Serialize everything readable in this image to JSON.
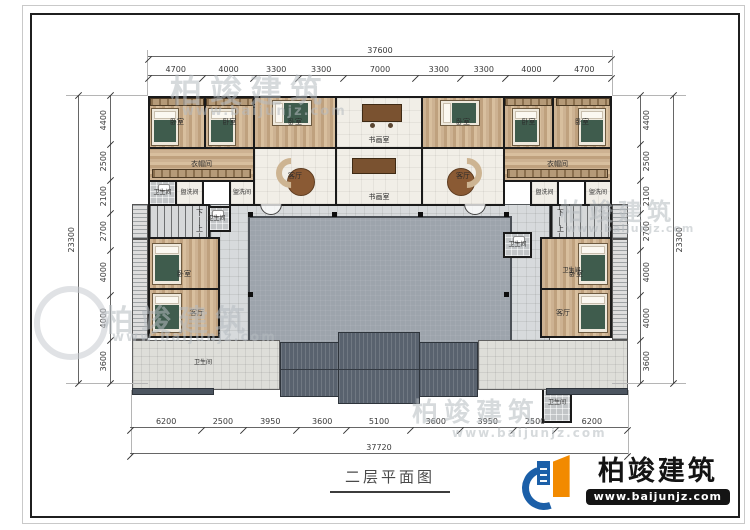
{
  "title": "二层平面图",
  "logo": {
    "brand": "柏竣建筑",
    "url": "www.baijunjz.com"
  },
  "watermark": {
    "brand": "柏竣建筑",
    "url": "www.baijunjz.com"
  },
  "labels": {
    "bedroom": "卧室",
    "study": "书画室",
    "living": "客厅",
    "cloak": "衣帽间",
    "bath": "卫生间",
    "wash": "盥洗间",
    "down": "下",
    "up": "上"
  },
  "dims": {
    "top_total": "37600",
    "top": [
      "4700",
      "4000",
      "3300",
      "3300",
      "7000",
      "3300",
      "3300",
      "4000",
      "4700"
    ],
    "bottom": [
      "6200",
      "2500",
      "3950",
      "3600",
      "5100",
      "3600",
      "3950",
      "2500",
      "6200"
    ],
    "bottom_total": "37720",
    "left": [
      "4400",
      "2500",
      "2100",
      "2700",
      "4000",
      "4000",
      "3600"
    ],
    "left_total": "23300",
    "right": [
      "4400",
      "2500",
      "2100",
      "2700",
      "4000",
      "4000",
      "3600"
    ],
    "right_total": "23300"
  }
}
